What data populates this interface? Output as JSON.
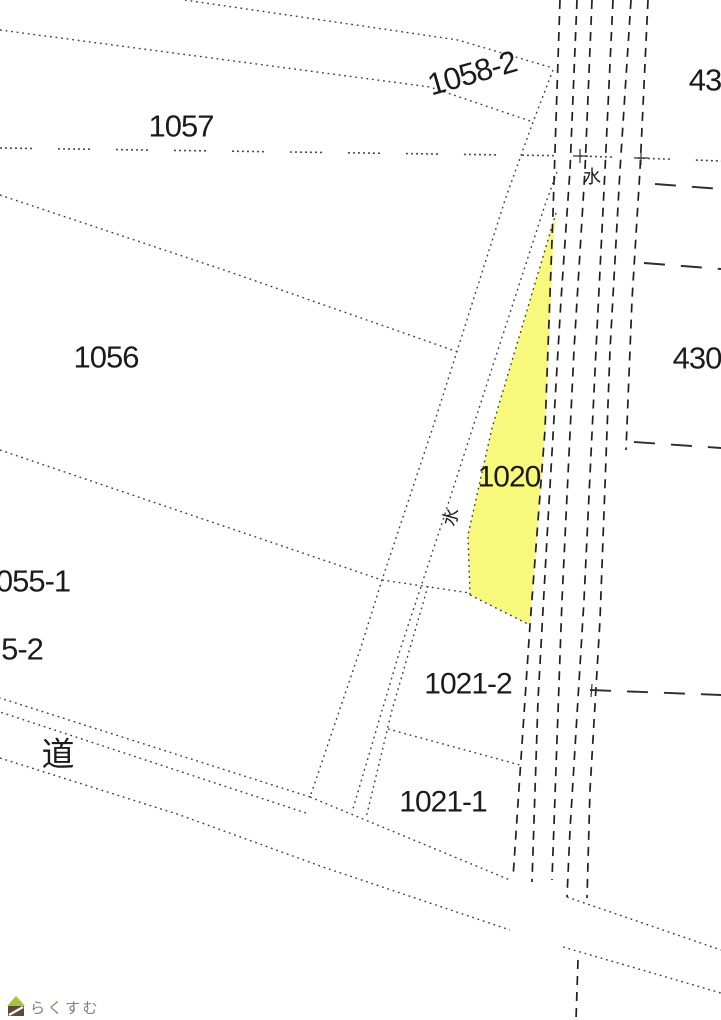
{
  "map": {
    "type": "cadastral-parcel-map",
    "background_color": "#ffffff",
    "boundary_line_color": "#3f3f3f",
    "waterway_line_color": "#1f1f1f",
    "highlight": {
      "parcel": "1020",
      "fill_color": "#f8f87d"
    },
    "labels": [
      {
        "id": "1058-2",
        "text": "1058-2",
        "x": 472,
        "y": 73,
        "size": 31,
        "rot": -16,
        "kind": "parcel"
      },
      {
        "id": "1057",
        "text": "1057",
        "x": 181,
        "y": 126,
        "size": 31,
        "rot": 0,
        "kind": "parcel"
      },
      {
        "id": "43",
        "text": "43",
        "x": 705,
        "y": 80,
        "size": 31,
        "rot": 0,
        "kind": "parcel"
      },
      {
        "id": "1056",
        "text": "1056",
        "x": 106,
        "y": 357,
        "size": 31,
        "rot": 0,
        "kind": "parcel"
      },
      {
        "id": "430",
        "text": "430",
        "x": 697,
        "y": 358,
        "size": 31,
        "rot": 0,
        "kind": "parcel"
      },
      {
        "id": "1020",
        "text": "1020",
        "x": 509,
        "y": 477,
        "size": 30,
        "rot": 0,
        "kind": "parcel"
      },
      {
        "id": "055-1",
        "text": "055-1",
        "x": 33,
        "y": 581,
        "size": 31,
        "rot": 0,
        "kind": "parcel"
      },
      {
        "id": "5-2",
        "text": "5-2",
        "x": 22,
        "y": 649,
        "size": 31,
        "rot": 0,
        "kind": "parcel"
      },
      {
        "id": "1021-2",
        "text": "1021-2",
        "x": 468,
        "y": 684,
        "size": 30,
        "rot": 0,
        "kind": "parcel"
      },
      {
        "id": "1021-1",
        "text": "1021-1",
        "x": 443,
        "y": 802,
        "size": 30,
        "rot": 0,
        "kind": "parcel"
      },
      {
        "id": "michi",
        "text": "道",
        "x": 58,
        "y": 754,
        "size": 33,
        "rot": 0,
        "kind": "kanji"
      },
      {
        "id": "mizu-upper",
        "text": "水",
        "x": 592,
        "y": 177,
        "size": 18,
        "rot": 0,
        "kind": "kanji"
      },
      {
        "id": "mizu-lower",
        "text": "水",
        "x": 451,
        "y": 517,
        "size": 18,
        "rot": -75,
        "kind": "kanji"
      }
    ],
    "watermark": {
      "text": "らくすむ",
      "text_color": "#8b7a6e",
      "roof_color": "#a8c13e",
      "house_color": "#5d4a3b"
    }
  }
}
